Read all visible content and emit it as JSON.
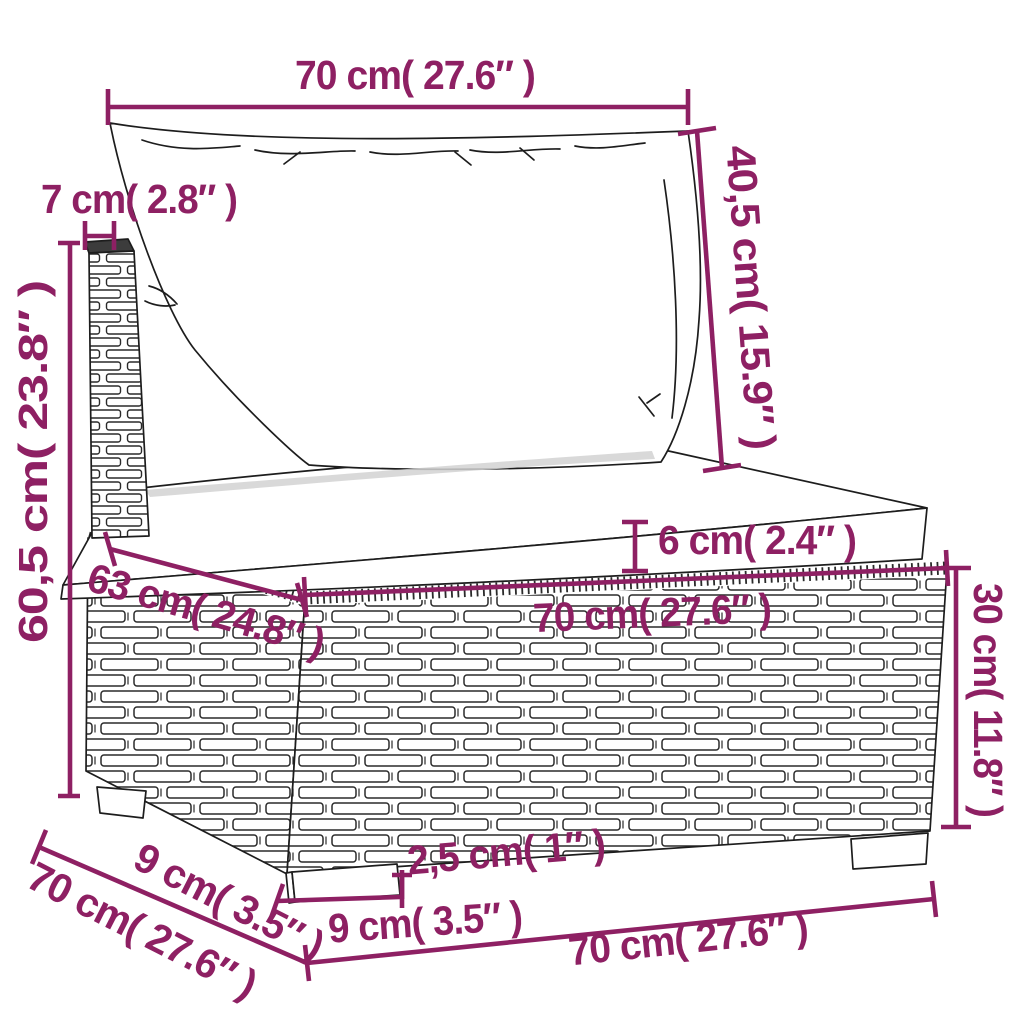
{
  "diagram": {
    "title": "Rattan garden sofa section dimension diagram",
    "unit_system": "cm / inches",
    "accent_color": "#8E2063",
    "line_color": "#1d1d1d",
    "background": "#ffffff"
  },
  "dim": {
    "top_width": "70 cm( 27.6″ )",
    "back_cushion_height": "40,5 cm( 15.9″ )",
    "back_frame_width": "7 cm( 2.8″ )",
    "total_height": "60,5 cm( 23.8″ )",
    "seat_depth": "63 cm( 24.8″ )",
    "cushion_thickness": "6 cm( 2.4″ )",
    "seat_width": "70 cm( 27.6″ )",
    "base_height": "30 cm( 11.8″ )",
    "base_front_width": "70 cm( 27.6″ )",
    "base_depth": "70 cm( 27.6″ )",
    "foot_depth": "9 cm( 3.5″ )",
    "foot_width": "9 cm( 3.5″ )",
    "foot_height": "2,5 cm( 1″ )"
  }
}
